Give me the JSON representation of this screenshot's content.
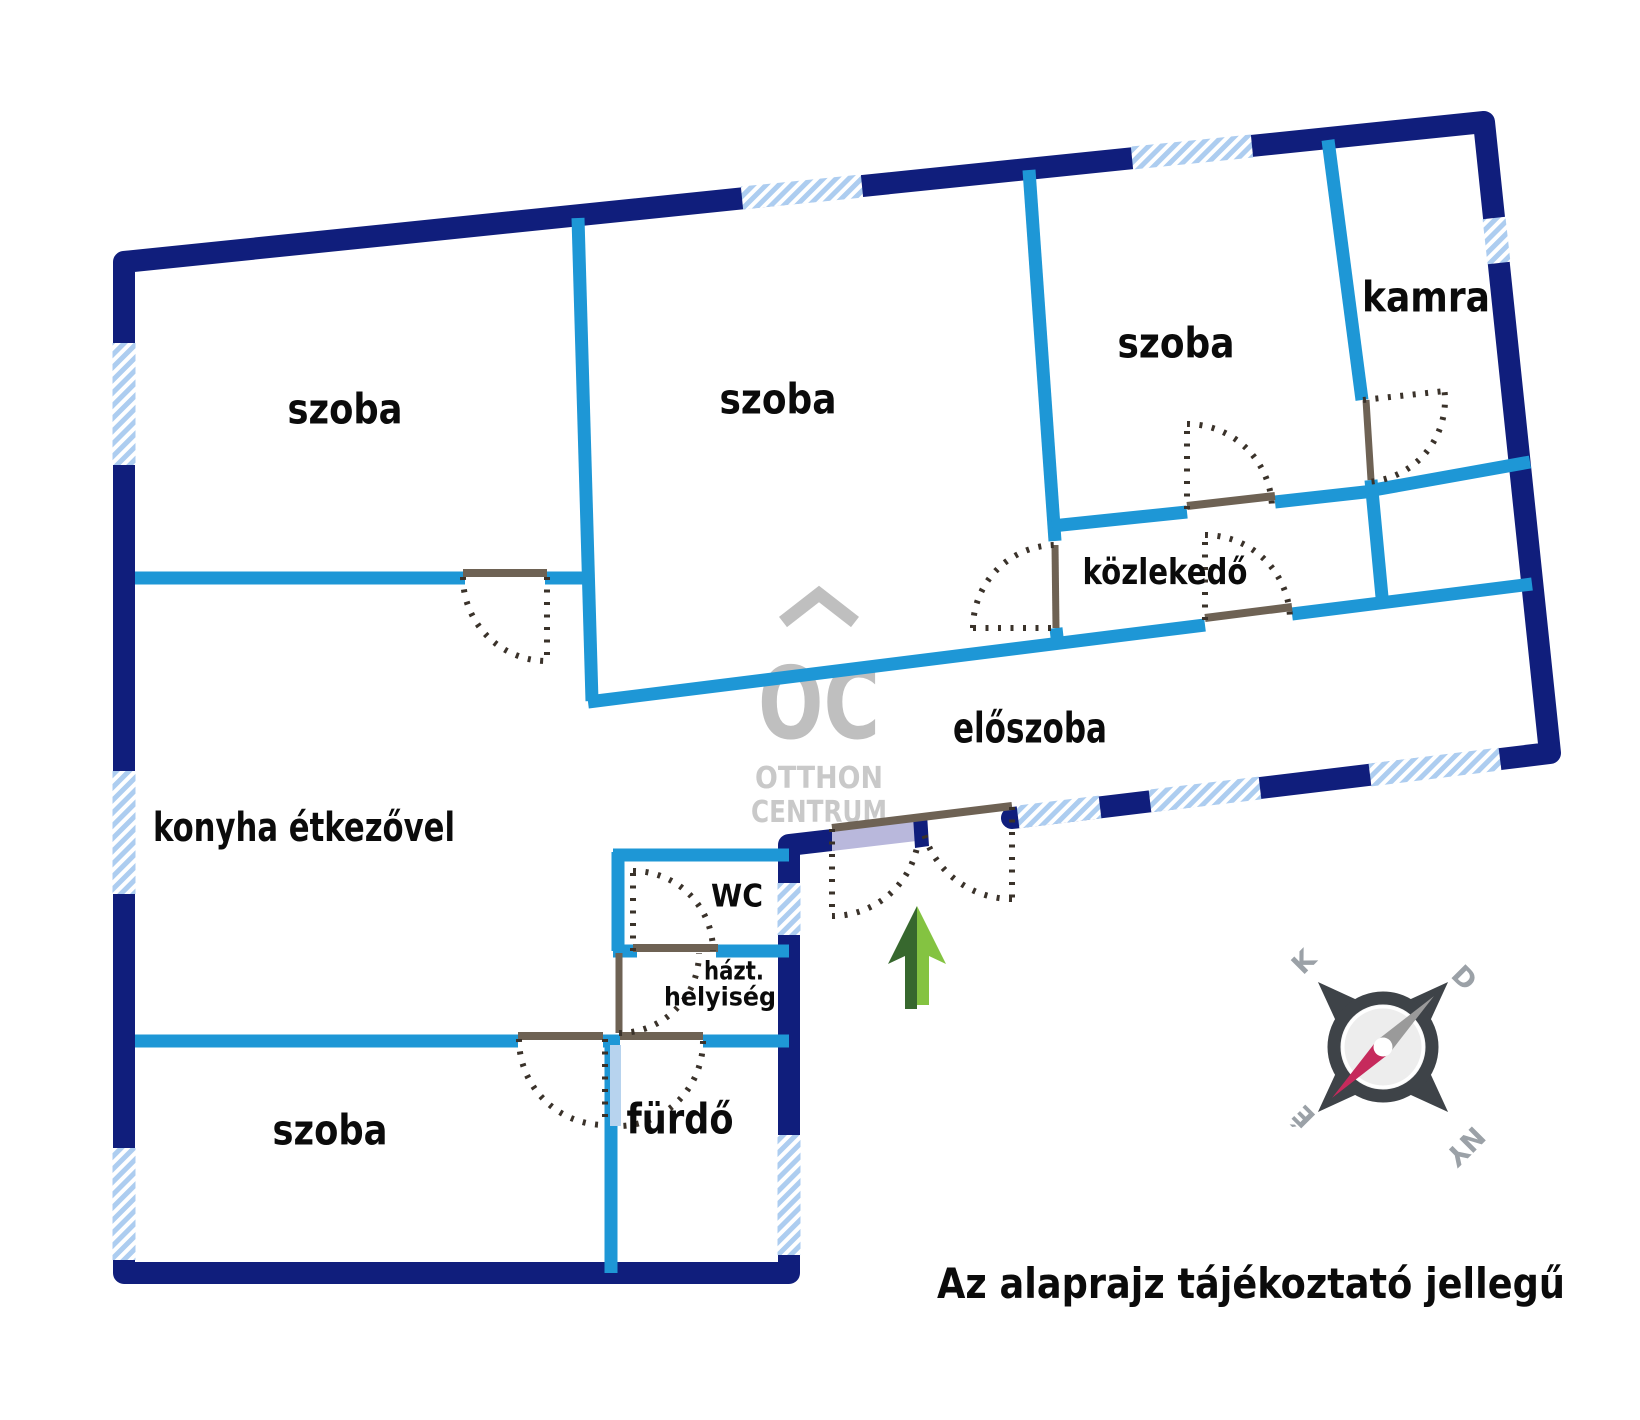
{
  "meta": {
    "width": 1640,
    "height": 1420,
    "colors": {
      "outer_wall": "#101e7c",
      "inner_wall": "#1e97d6",
      "window_base": "#adcdf0",
      "window_stripe": "#ffffff",
      "door_leaf": "#6e6254",
      "door_swing_dots": "#3a322a",
      "entrance_fill": "#b9b8dc",
      "pale_leaf": "#b7d3ee",
      "label_text": "#0b0b0b",
      "watermark": "#bfbfbf",
      "watermark_light": "#c9c9c9",
      "compass_dark": "#3e4348",
      "compass_face": "#ededed",
      "compass_ring_fill": "#f7f7f7",
      "compass_letters": "#9ba1a7",
      "needle_gray": "#9a9a9a",
      "needle_red": "#c62a5c",
      "arrow_dark": "#37682e",
      "arrow_light": "#84c341"
    }
  },
  "rooms": [
    {
      "name": "room-label-szoba-top-left",
      "label": "szoba",
      "x": 345,
      "y": 412,
      "size": 42,
      "len": 115
    },
    {
      "name": "room-label-szoba-top-mid",
      "label": "szoba",
      "x": 778,
      "y": 402,
      "size": 42,
      "len": 117
    },
    {
      "name": "room-label-szoba-top-right",
      "label": "szoba",
      "x": 1176,
      "y": 346,
      "size": 42,
      "len": 117
    },
    {
      "name": "room-label-kamra",
      "label": "kamra",
      "x": 1426,
      "y": 300,
      "size": 42,
      "len": 128
    },
    {
      "name": "room-label-kozlekedo",
      "label": "közlekedő",
      "x": 1165,
      "y": 574,
      "size": 36,
      "len": 165
    },
    {
      "name": "room-label-eloszoba",
      "label": "előszoba",
      "x": 1030,
      "y": 731,
      "size": 42,
      "len": 154
    },
    {
      "name": "room-label-konyha",
      "label": "konyha étkezővel",
      "x": 304,
      "y": 830,
      "size": 40,
      "len": 302
    },
    {
      "name": "room-label-wc",
      "label": "WC",
      "x": 737,
      "y": 898,
      "size": 31,
      "len": 52
    },
    {
      "name": "room-label-hazt-line1",
      "label": "házt.",
      "x": 734,
      "y": 972,
      "size": 26,
      "len": 60
    },
    {
      "name": "room-label-hazt-line2",
      "label": "helyiség",
      "x": 720,
      "y": 998,
      "size": 26,
      "len": 112
    },
    {
      "name": "room-label-furdo",
      "label": "fürdő",
      "x": 680,
      "y": 1122,
      "size": 42,
      "len": 107
    },
    {
      "name": "room-label-szoba-bottom",
      "label": "szoba",
      "x": 330,
      "y": 1133,
      "size": 42,
      "len": 115
    }
  ],
  "walls": {
    "outer_width": 22,
    "inner_width": 13,
    "outer": [
      [
        [
          832,
          840
        ],
        [
          789,
          845
        ],
        [
          789,
          1273
        ],
        [
          124,
          1273
        ],
        [
          124,
          262
        ],
        [
          1484,
          122
        ],
        [
          1550,
          753
        ],
        [
          1012,
          818
        ]
      ]
    ],
    "inner": [
      [
        [
          135,
          578
        ],
        [
          465,
          578
        ]
      ],
      [
        [
          545,
          578
        ],
        [
          590,
          578
        ]
      ],
      [
        [
          578,
          218
        ],
        [
          592,
          701
        ]
      ],
      [
        [
          588,
          702
        ],
        [
          1205,
          625
        ]
      ],
      [
        [
          1292,
          614
        ],
        [
          1532,
          584
        ]
      ],
      [
        [
          1029,
          170
        ],
        [
          1055,
          541
        ]
      ],
      [
        [
          1056,
          628
        ],
        [
          1058,
          646
        ]
      ],
      [
        [
          1052,
          526
        ],
        [
          1187,
          512
        ]
      ],
      [
        [
          1275,
          502
        ],
        [
          1374,
          491
        ]
      ],
      [
        [
          1328,
          140
        ],
        [
          1362,
          400
        ]
      ],
      [
        [
          1371,
          480
        ],
        [
          1382,
          597
        ]
      ],
      [
        [
          1368,
          491
        ],
        [
          1530,
          462
        ]
      ],
      [
        [
          613,
          855
        ],
        [
          789,
          855
        ]
      ],
      [
        [
          618,
          852
        ],
        [
          618,
          951
        ]
      ],
      [
        [
          613,
          951
        ],
        [
          637,
          951
        ]
      ],
      [
        [
          716,
          951
        ],
        [
          789,
          951
        ]
      ],
      [
        [
          135,
          1041
        ],
        [
          518,
          1041
        ]
      ],
      [
        [
          603,
          1041
        ],
        [
          620,
          1041
        ]
      ],
      [
        [
          703,
          1041
        ],
        [
          789,
          1041
        ]
      ],
      [
        [
          611,
          1041
        ],
        [
          611,
          1273
        ]
      ]
    ]
  },
  "windows": {
    "stroke_width": 23,
    "segments": [
      {
        "name": "window-left-1",
        "x1": 124,
        "y1": 343,
        "x2": 124,
        "y2": 465
      },
      {
        "name": "window-left-2",
        "x1": 124,
        "y1": 771,
        "x2": 124,
        "y2": 894
      },
      {
        "name": "window-left-3",
        "x1": 124,
        "y1": 1148,
        "x2": 124,
        "y2": 1260
      },
      {
        "name": "window-top-1",
        "x1": 742,
        "y1": 198,
        "x2": 862,
        "y2": 186
      },
      {
        "name": "window-top-2",
        "x1": 1132,
        "y1": 158,
        "x2": 1252,
        "y2": 146
      },
      {
        "name": "window-right-kamra",
        "x1": 1494,
        "y1": 218,
        "x2": 1499,
        "y2": 263
      },
      {
        "name": "window-eloszoba-1",
        "x1": 1018,
        "y1": 817,
        "x2": 1100,
        "y2": 807
      },
      {
        "name": "window-eloszoba-2",
        "x1": 1150,
        "y1": 801,
        "x2": 1260,
        "y2": 788
      },
      {
        "name": "window-eloszoba-3",
        "x1": 1370,
        "y1": 775,
        "x2": 1500,
        "y2": 759
      },
      {
        "name": "window-wc-side",
        "x1": 789,
        "y1": 883,
        "x2": 789,
        "y2": 935
      },
      {
        "name": "window-furdo-side",
        "x1": 789,
        "y1": 1135,
        "x2": 789,
        "y2": 1255
      }
    ]
  },
  "doors": {
    "lintel_width": 8,
    "leaf_width": 7,
    "dot_width": 6,
    "dot_dash": "3 9.5",
    "lintels": [
      {
        "name": "door-lintel-szoba-tl",
        "x1": 463,
        "y1": 573,
        "x2": 547,
        "y2": 573
      },
      {
        "name": "door-lintel-szoba-tr",
        "x1": 1187,
        "y1": 506,
        "x2": 1275,
        "y2": 496
      },
      {
        "name": "door-lintel-kozlekedo",
        "x1": 1205,
        "y1": 618,
        "x2": 1292,
        "y2": 607
      },
      {
        "name": "door-lintel-wc",
        "x1": 633,
        "y1": 948,
        "x2": 718,
        "y2": 948
      },
      {
        "name": "door-lintel-szoba-bl",
        "x1": 518,
        "y1": 1036,
        "x2": 603,
        "y2": 1036
      },
      {
        "name": "door-lintel-furdo",
        "x1": 620,
        "y1": 1036,
        "x2": 703,
        "y2": 1036
      },
      {
        "name": "door-lintel-entrance",
        "x1": 832,
        "y1": 828,
        "x2": 1012,
        "y2": 806
      }
    ],
    "leaves": [
      {
        "name": "door-leaf-szoba-mid",
        "x1": 1055,
        "y1": 545,
        "x2": 1056,
        "y2": 628
      },
      {
        "name": "door-leaf-kamra",
        "x1": 1366,
        "y1": 400,
        "x2": 1371,
        "y2": 480
      },
      {
        "name": "door-leaf-hazt",
        "x1": 619,
        "y1": 953,
        "x2": 619,
        "y2": 1033
      }
    ],
    "pale_leaf": {
      "name": "door-leaf-furdo-open",
      "x": 610,
      "y": 1045,
      "w": 11,
      "h": 81
    },
    "arcs": [
      {
        "name": "door-swing-szoba-tl",
        "cx": 547,
        "cy": 577,
        "r": 84,
        "a1": 180,
        "a2": 90
      },
      {
        "name": "door-swing-szoba-mid",
        "cx": 1056,
        "cy": 628,
        "r": 83,
        "a1": 180,
        "a2": 270
      },
      {
        "name": "door-swing-szoba-tr",
        "cx": 1187,
        "cy": 509,
        "r": 85,
        "a1": 270,
        "a2": 360
      },
      {
        "name": "door-swing-kozlekedo",
        "cx": 1205,
        "cy": 620,
        "r": 85,
        "a1": 270,
        "a2": 360
      },
      {
        "name": "door-swing-kamra",
        "cx": 1363,
        "cy": 400,
        "r": 82,
        "a1": 84,
        "a2": -6
      },
      {
        "name": "door-swing-wc",
        "cx": 633,
        "cy": 951,
        "r": 80,
        "a1": 270,
        "a2": 360
      },
      {
        "name": "door-swing-hazt",
        "cx": 619,
        "cy": 953,
        "r": 80,
        "a1": 90,
        "a2": 0
      },
      {
        "name": "door-swing-szoba-bl",
        "cx": 605,
        "cy": 1039,
        "r": 86,
        "a1": 180,
        "a2": 90
      },
      {
        "name": "door-swing-furdo",
        "cx": 618,
        "cy": 1041,
        "r": 85,
        "a1": 0,
        "a2": 90
      },
      {
        "name": "door-swing-entrance-l",
        "cx": 832,
        "cy": 829,
        "r": 87,
        "a1": 90,
        "a2": 8
      },
      {
        "name": "door-swing-entrance-r",
        "cx": 1012,
        "cy": 807,
        "r": 92,
        "a1": 90,
        "a2": 164
      }
    ],
    "dotted_lines": [
      {
        "x1": 547,
        "y1": 577,
        "x2": 547,
        "y2": 661
      },
      {
        "x1": 973,
        "y1": 628,
        "x2": 1056,
        "y2": 628
      },
      {
        "x1": 1187,
        "y1": 509,
        "x2": 1187,
        "y2": 424
      },
      {
        "x1": 1205,
        "y1": 620,
        "x2": 1205,
        "y2": 535
      },
      {
        "x1": 1363,
        "y1": 400,
        "x2": 1445,
        "y2": 391
      },
      {
        "x1": 633,
        "y1": 951,
        "x2": 633,
        "y2": 871
      },
      {
        "x1": 605,
        "y1": 1039,
        "x2": 605,
        "y2": 1125
      },
      {
        "x1": 832,
        "y1": 829,
        "x2": 832,
        "y2": 916
      },
      {
        "x1": 1012,
        "y1": 807,
        "x2": 1012,
        "y2": 899
      }
    ]
  },
  "entrance": {
    "panel_points": "832,829 925,818 925,840 832,851",
    "stopper_points": "913,816 927,814 929,846 915,848"
  },
  "compass": {
    "cx": 1383,
    "cy": 1047,
    "ring_r": 49,
    "ring_w": 13,
    "face_r": 40,
    "arm_tip": 92,
    "arm_base": 38,
    "arm_half_w": 20,
    "needle_len": 72,
    "needle_half_w": 9,
    "hub_r": 9.5,
    "letters": [
      {
        "label": "K",
        "x": 1305,
        "y": 963,
        "rot": -45
      },
      {
        "label": "D",
        "x": 1463,
        "y": 979,
        "rot": 45
      },
      {
        "label": "É",
        "x": 1305,
        "y": 1115,
        "rot": -135
      },
      {
        "label": "NY",
        "x": 1464,
        "y": 1145,
        "rot": 135
      }
    ],
    "letter_size": 27
  },
  "arrow": {
    "dark_points": "917,906 888,964 905,956 905,1009 917,1009",
    "light_points": "917,906 946,964 929,956 929,1005 917,1005"
  },
  "watermark": {
    "logo_text": "OC",
    "logo_x": 819,
    "logo_y": 738,
    "logo_size": 100,
    "logo_len": 122,
    "chevron_points": "783,622 819,594 855,622",
    "chevron_w": 13,
    "line1": "OTTHON",
    "line1_x": 819,
    "line1_y": 788,
    "line1_size": 30,
    "line1_len": 128,
    "line2": "CENTRUM",
    "line2_x": 819,
    "line2_y": 822,
    "line2_size": 30,
    "line2_len": 136
  },
  "disclaimer": {
    "text": "Az alaprajz tájékoztató jellegű",
    "x": 937,
    "y": 1298,
    "size": 42,
    "len": 628
  }
}
